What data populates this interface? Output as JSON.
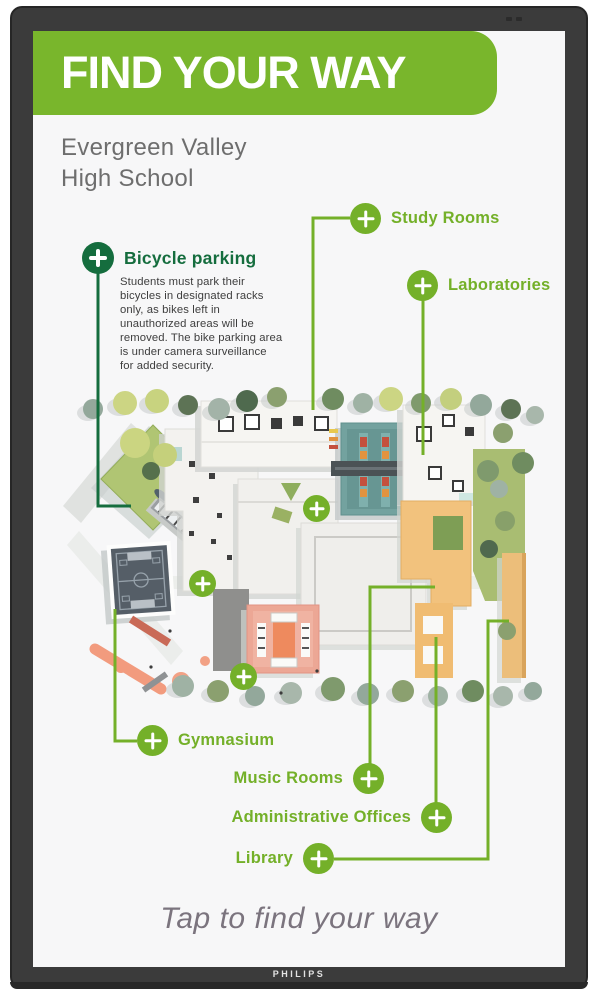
{
  "device": {
    "brand": "PHILIPS"
  },
  "header": {
    "title": "FIND YOUR WAY",
    "subtitle_line1": "Evergreen Valley",
    "subtitle_line2": "High School"
  },
  "poi": {
    "study_rooms": {
      "label": "Study Rooms"
    },
    "laboratories": {
      "label": "Laboratories"
    },
    "bicycle": {
      "label": "Bicycle parking",
      "description": "Students must park their\nbicycles in designated racks\nonly, as bikes left in\nunauthorized areas will be\nremoved. The bike parking area\nis under camera surveillance\nfor added security."
    },
    "gymnasium": {
      "label": "Gymnasium"
    },
    "music_rooms": {
      "label": "Music Rooms"
    },
    "admin_offices": {
      "label": "Administrative Offices"
    },
    "library": {
      "label": "Library"
    }
  },
  "footer": {
    "tap_text": "Tap to find your way"
  },
  "colors": {
    "accent_green": "#74b029",
    "accent_dark_green": "#156d3e",
    "banner_green": "#79b62c",
    "screen_background": "#f7f7f8",
    "bezel": "#3b3b3b"
  }
}
